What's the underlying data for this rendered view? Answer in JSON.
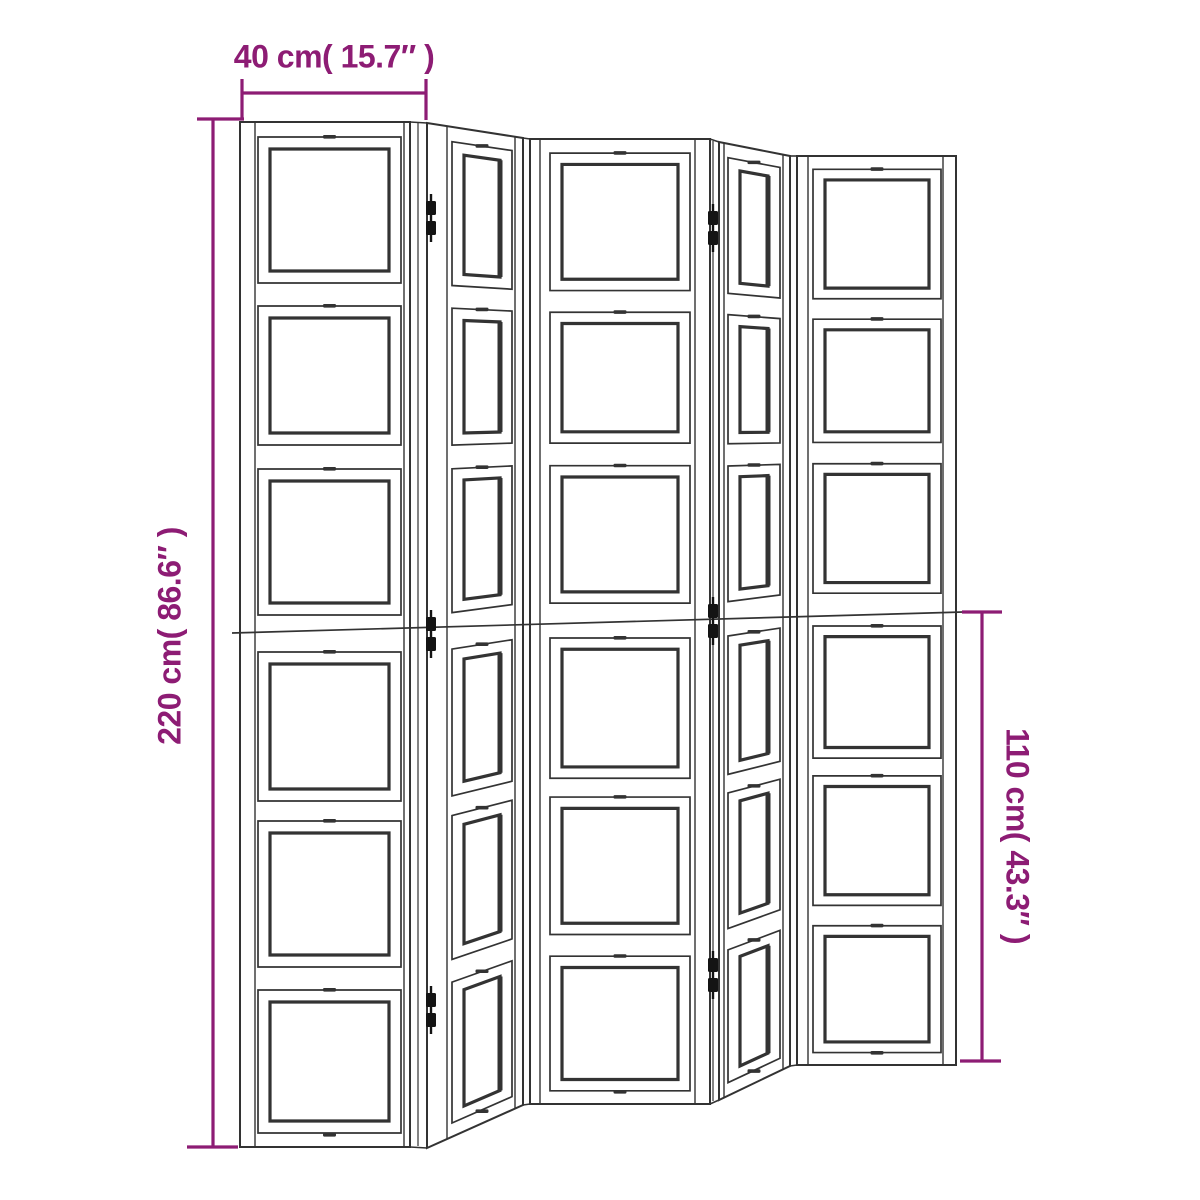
{
  "diagram": {
    "panel_count": 5,
    "frames_per_panel": 6,
    "labels": {
      "panel_width": "40 cm( 15.7″ )",
      "total_height": "220 cm( 86.6″ )",
      "half_height": "110 cm( 43.3″ )"
    },
    "values": {
      "panel_width_cm": 40,
      "panel_width_in": 15.7,
      "total_height_cm": 220,
      "total_height_in": 86.6,
      "half_height_cm": 110,
      "half_height_in": 43.3
    },
    "colors": {
      "dimension": "#8d1c74",
      "line": "#333333",
      "hinge": "#141414",
      "background": "#ffffff"
    }
  }
}
